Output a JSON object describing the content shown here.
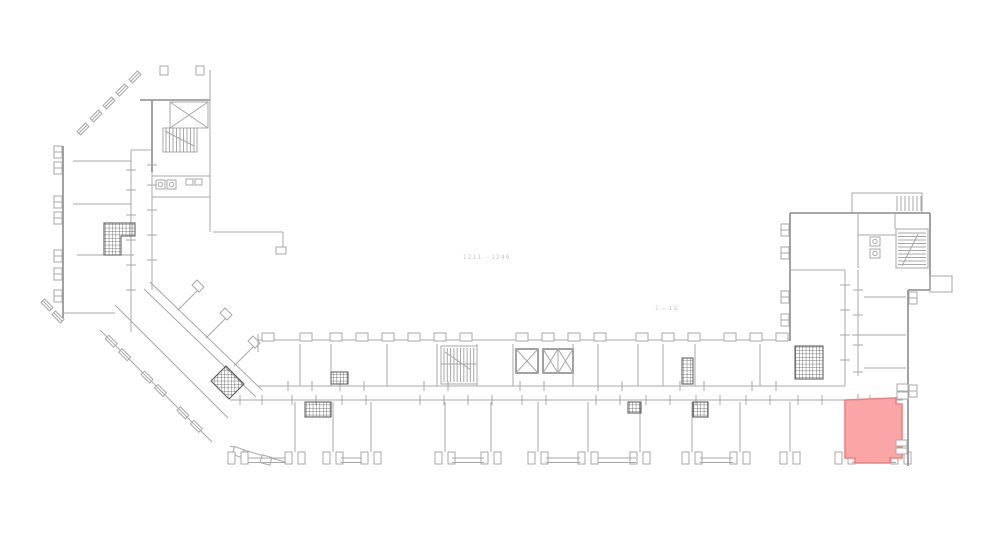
{
  "plan": {
    "annotations": [
      {
        "id": "range-label-west",
        "text": "1211 - 1246"
      },
      {
        "id": "range-label-east",
        "text": "1 - 12"
      }
    ],
    "highlighted_room": {
      "fill": "#fba6a6",
      "stroke": "#ee8181"
    },
    "colors": {
      "background": "#ffffff",
      "line": "#a8a8a8",
      "line_dark": "#8b8b8b",
      "hatch": "#777777",
      "hatch_dark": "#555555",
      "faint_text": "#c6c6c6",
      "highlight_fill": "#fba6a6",
      "highlight_stroke": "#ee8181"
    }
  }
}
